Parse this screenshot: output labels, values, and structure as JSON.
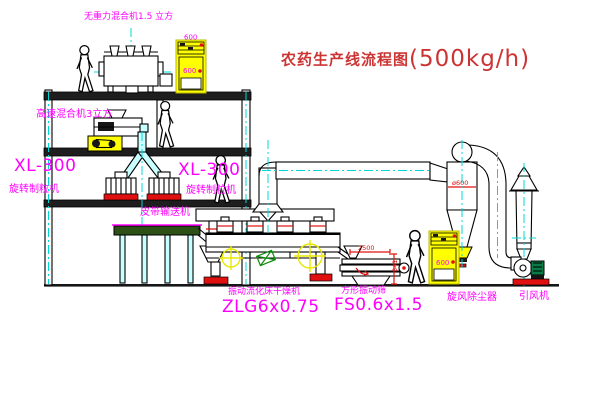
{
  "title": {
    "text_cn": "农药生产线流程图",
    "capacity": "(500kg/h)"
  },
  "equipment_labels": {
    "top_mixer": "无重力混合机1.5 立方",
    "mid_mixer": "高速混合机3立方",
    "granulator_left_model": "XL-300",
    "granulator_left_name": "旋转制粒机",
    "granulator_mid_model": "XL-300",
    "granulator_mid_name": "旋转制粒机",
    "belt_conveyor": "皮带输送机",
    "dryer_name": "振动流化床干燥机",
    "dryer_model": "ZLG6x0.75",
    "sieve_name": "方形振动筛",
    "sieve_model": "FS0.6x1.5",
    "cyclone_name": "旋风除尘器",
    "fan_name": "引风机"
  },
  "dimensions": {
    "sieve_length": "2500",
    "sieve_height": "341",
    "cyclone_diameter": "ø600",
    "cabinet_mark": "600"
  },
  "colors": {
    "label_magenta": "#ff00ff",
    "title_red": "#cc3434",
    "dimension_red": "#e01010",
    "centerline_cyan": "#00d8d8",
    "cabinet_yellow": "#ffff00",
    "pipe_cyan_fill": "#c9ffff",
    "base_red": "#e01010",
    "belt_green": "#2d5016"
  }
}
